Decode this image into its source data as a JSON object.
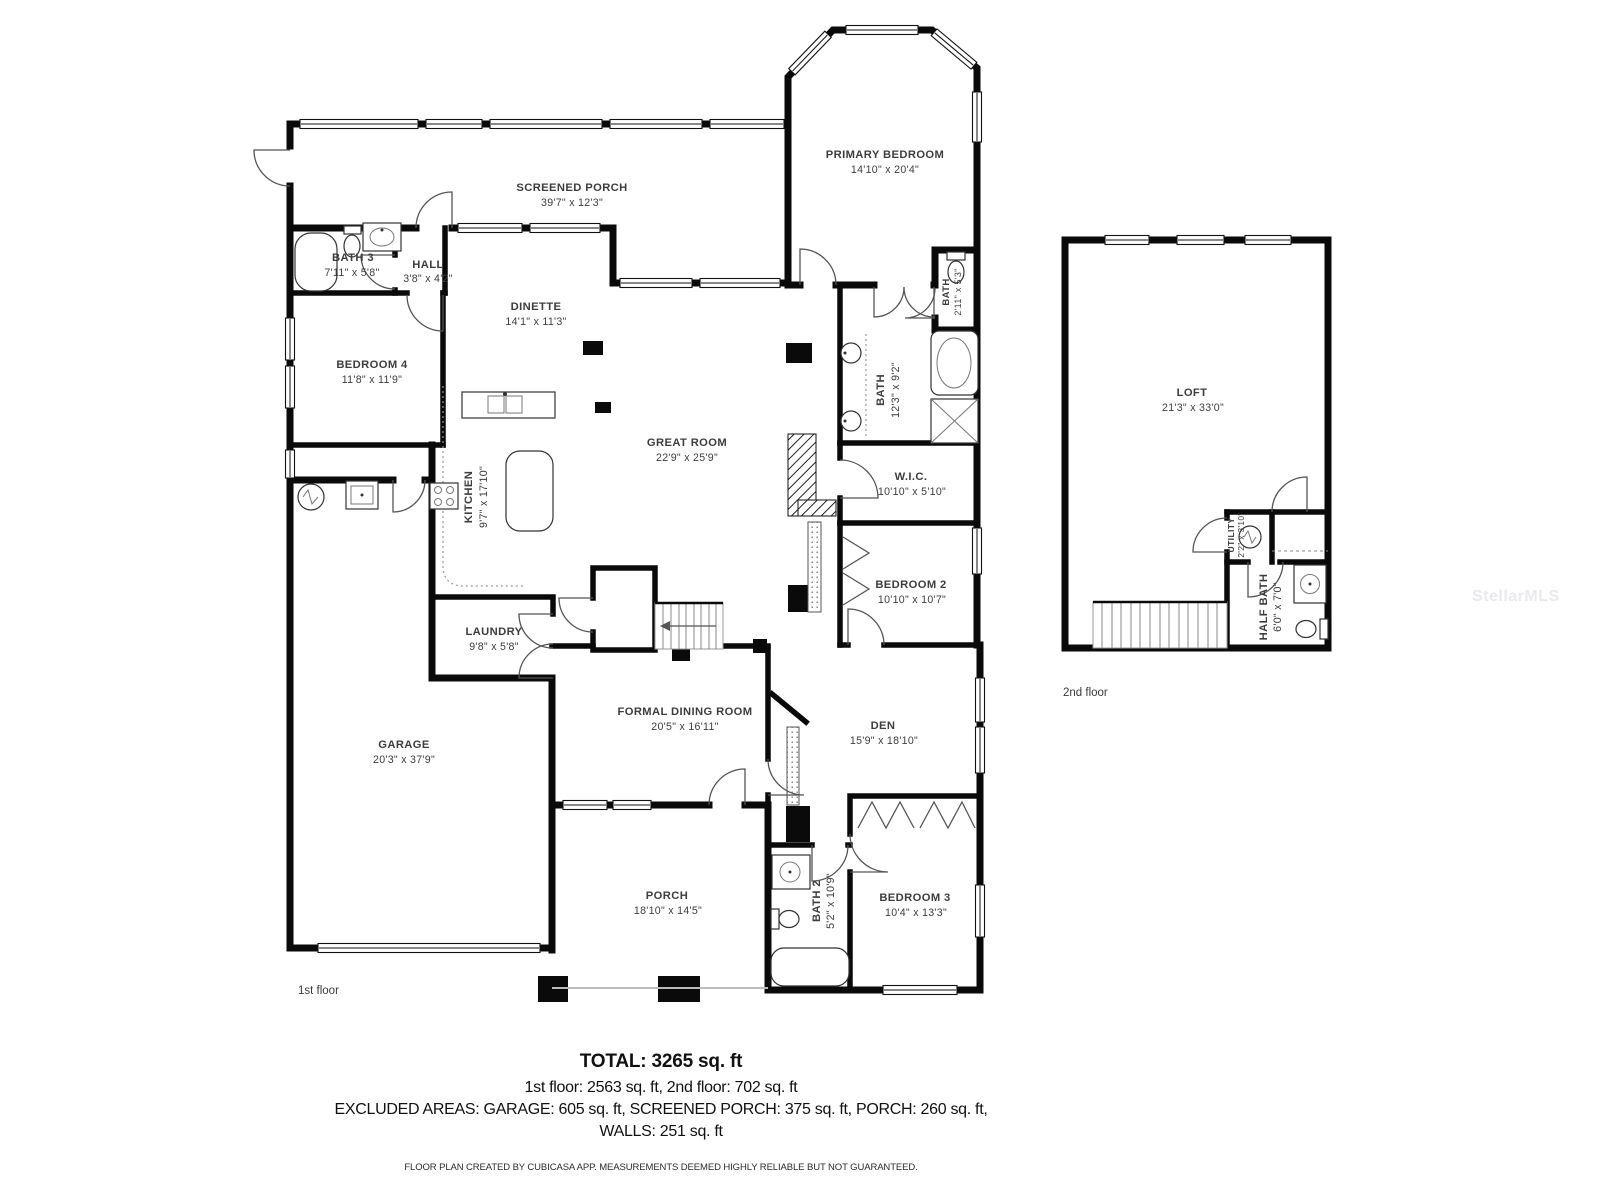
{
  "plan": {
    "floor1_label": "1st floor",
    "floor2_label": "2nd floor"
  },
  "rooms": {
    "screened_porch": {
      "name": "SCREENED PORCH",
      "dims": "39'7\" x 12'3\""
    },
    "primary_bedroom": {
      "name": "PRIMARY BEDROOM",
      "dims": "14'10\" x 20'4\""
    },
    "bath3": {
      "name": "BATH 3",
      "dims": "7'11\" x 5'8\""
    },
    "hall": {
      "name": "HALL",
      "dims": "3'8\" x 4'2\""
    },
    "bedroom4": {
      "name": "BEDROOM 4",
      "dims": "11'8\" x 11'9\""
    },
    "dinette": {
      "name": "DINETTE",
      "dims": "14'1\" x 11'3\""
    },
    "kitchen": {
      "name": "KITCHEN",
      "dims": "9'7\" x 17'10\""
    },
    "great_room": {
      "name": "GREAT ROOM",
      "dims": "22'9\" x 25'9\""
    },
    "primary_bath": {
      "name": "BATH",
      "dims": "12'3\" x 9'2\""
    },
    "bath_small": {
      "name": "BATH",
      "dims": "2'11\" x 5'3\""
    },
    "wic": {
      "name": "W.I.C.",
      "dims": "10'10\" x 5'10\""
    },
    "bedroom2": {
      "name": "BEDROOM 2",
      "dims": "10'10\" x 10'7\""
    },
    "laundry": {
      "name": "LAUNDRY",
      "dims": "9'8\" x 5'8\""
    },
    "garage": {
      "name": "GARAGE",
      "dims": "20'3\" x 37'9\""
    },
    "formal_dining": {
      "name": "FORMAL DINING ROOM",
      "dims": "20'5\" x 16'11\""
    },
    "den": {
      "name": "DEN",
      "dims": "15'9\" x 18'10\""
    },
    "porch": {
      "name": "PORCH",
      "dims": "18'10\" x 14'5\""
    },
    "bath2": {
      "name": "BATH 2",
      "dims": "5'2\" x 10'9\""
    },
    "bedroom3": {
      "name": "BEDROOM 3",
      "dims": "10'4\" x 13'3\""
    },
    "loft": {
      "name": "LOFT",
      "dims": "21'3\" x 33'0\""
    },
    "utility": {
      "name": "UTILITY",
      "dims": "2'2\" x 3'10\""
    },
    "half_bath": {
      "name": "HALF BATH",
      "dims": "6'0\" x 7'0\""
    }
  },
  "summary": {
    "total": "TOTAL: 3265 sq. ft",
    "floors": "1st floor: 2563 sq. ft, 2nd floor: 702 sq. ft",
    "excluded": "EXCLUDED AREAS: GARAGE: 605 sq. ft, SCREENED PORCH: 375 sq. ft, PORCH: 260 sq. ft,",
    "walls": "WALLS: 251 sq. ft"
  },
  "footer": "FLOOR PLAN CREATED BY CUBICASA APP. MEASUREMENTS DEEMED HIGHLY RELIABLE BUT NOT GUARANTEED.",
  "watermark": "StellarMLS"
}
